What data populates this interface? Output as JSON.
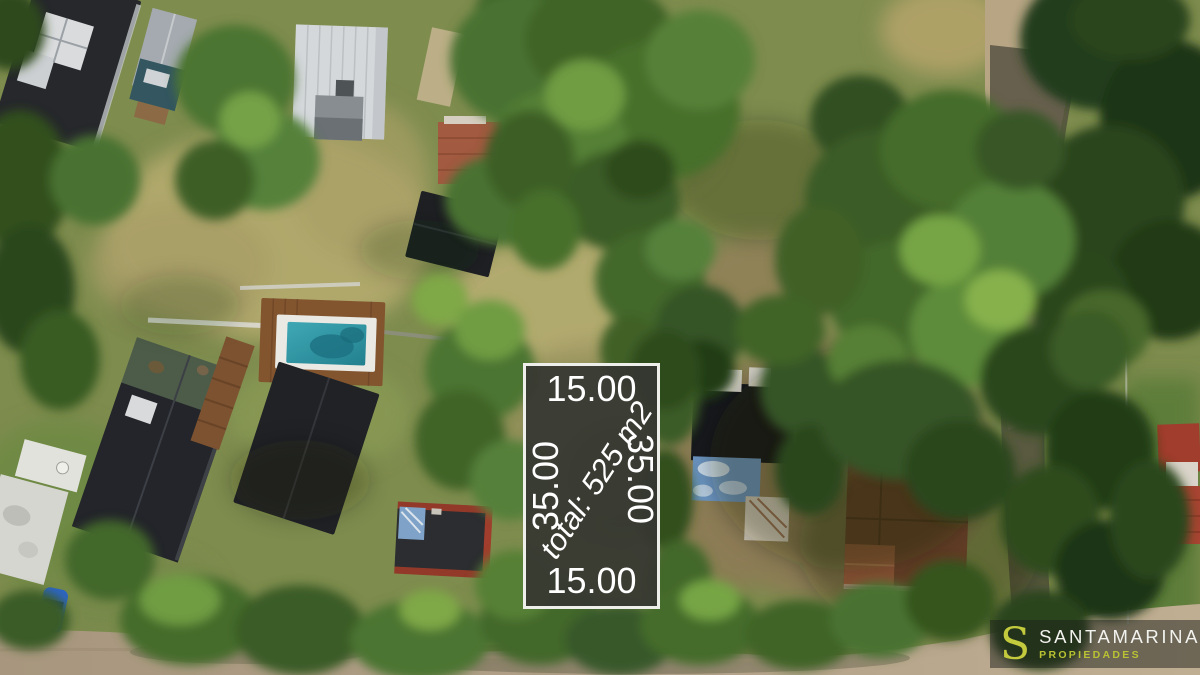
{
  "plot_overlay": {
    "width_top_label": "15.00",
    "width_bottom_label": "15.00",
    "depth_left_label": "35.00",
    "depth_right_label": "35.00",
    "area_label": "total: 525 m2",
    "fill_color": "#363732",
    "border_color": "#f3f3f0",
    "text_color": "#ffffff"
  },
  "watermark": {
    "logo_letter": "S",
    "brand_name": "SANTAMARINA",
    "brand_subtitle": "PROPIEDADES",
    "accent_color": "#c3ca3d",
    "name_color": "#f2f2ef",
    "panel_color": "rgba(28,32,26,0.5)"
  },
  "scene": {
    "palette": {
      "tree_dark": "#243c1a",
      "tree_mid": "#43682c",
      "tree_bright": "#76a544",
      "grass_green": "#7e8c4e",
      "grass_dry": "#b3a96e",
      "dirt_road": "#b2a189",
      "pool_water": "#2f9aa8",
      "pool_deck": "#7c5231",
      "roof_dark": "#1f2125",
      "roof_metal": "#a2a8ad",
      "roof_white": "#d3d7da",
      "roof_terracotta": "#a25a40",
      "tarp_blue": "#6b94bf",
      "car_blue": "#2e66c4"
    }
  }
}
